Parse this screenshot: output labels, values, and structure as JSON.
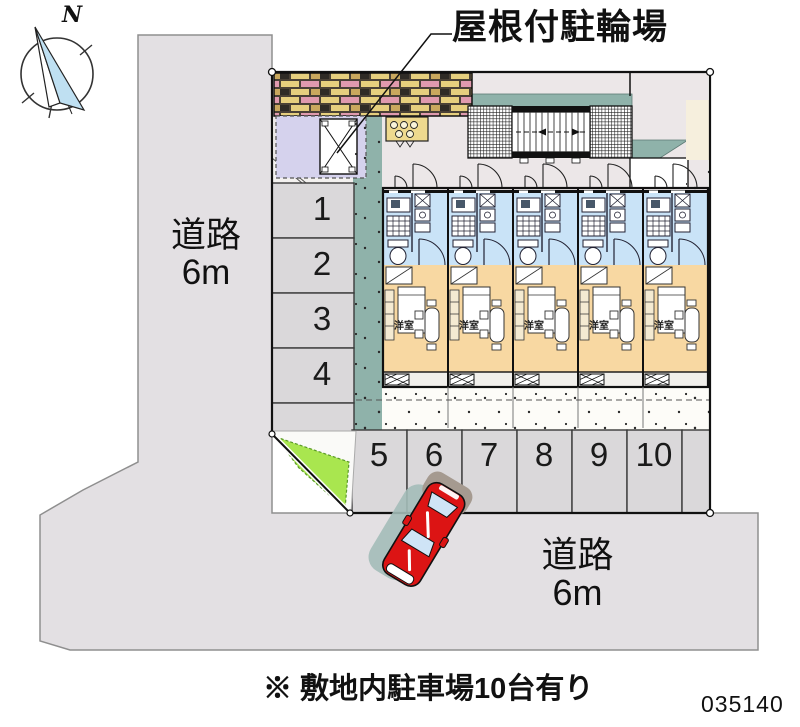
{
  "compass": {
    "north_label": "N"
  },
  "labels": {
    "bicycle_parking": "屋根付駐輪場",
    "left_road_line1": "道路",
    "left_road_line2": "6m",
    "bottom_road_line1": "道路",
    "bottom_road_line2": "6m",
    "footer_note": "※ 敷地内駐車場10台有り",
    "plan_number": "035140"
  },
  "parking": {
    "left_stalls": [
      "1",
      "2",
      "3",
      "4"
    ],
    "bottom_stalls": [
      "5",
      "6",
      "7",
      "8",
      "9",
      "10"
    ]
  },
  "building": {
    "units": [
      {
        "room_label": "洋室"
      },
      {
        "room_label": "洋室"
      },
      {
        "room_label": "洋室"
      },
      {
        "room_label": "洋室"
      },
      {
        "room_label": "洋室"
      }
    ]
  },
  "colors": {
    "road": "#e3e0e3",
    "parking_stall": "#dad8da",
    "site_ground": "#fdfcf8",
    "concrete_apron": "#ece7e8",
    "gravel_cream": "#f6efdd",
    "roof_teal": "#8fb2aa",
    "bicycle_area_lavender": "#d5d2ed",
    "unit_wet_area_blue": "#c9e3f7",
    "unit_room_orange": "#f8d8a2",
    "grass_green": "#a9e64f",
    "car_red": "#dc1414"
  }
}
